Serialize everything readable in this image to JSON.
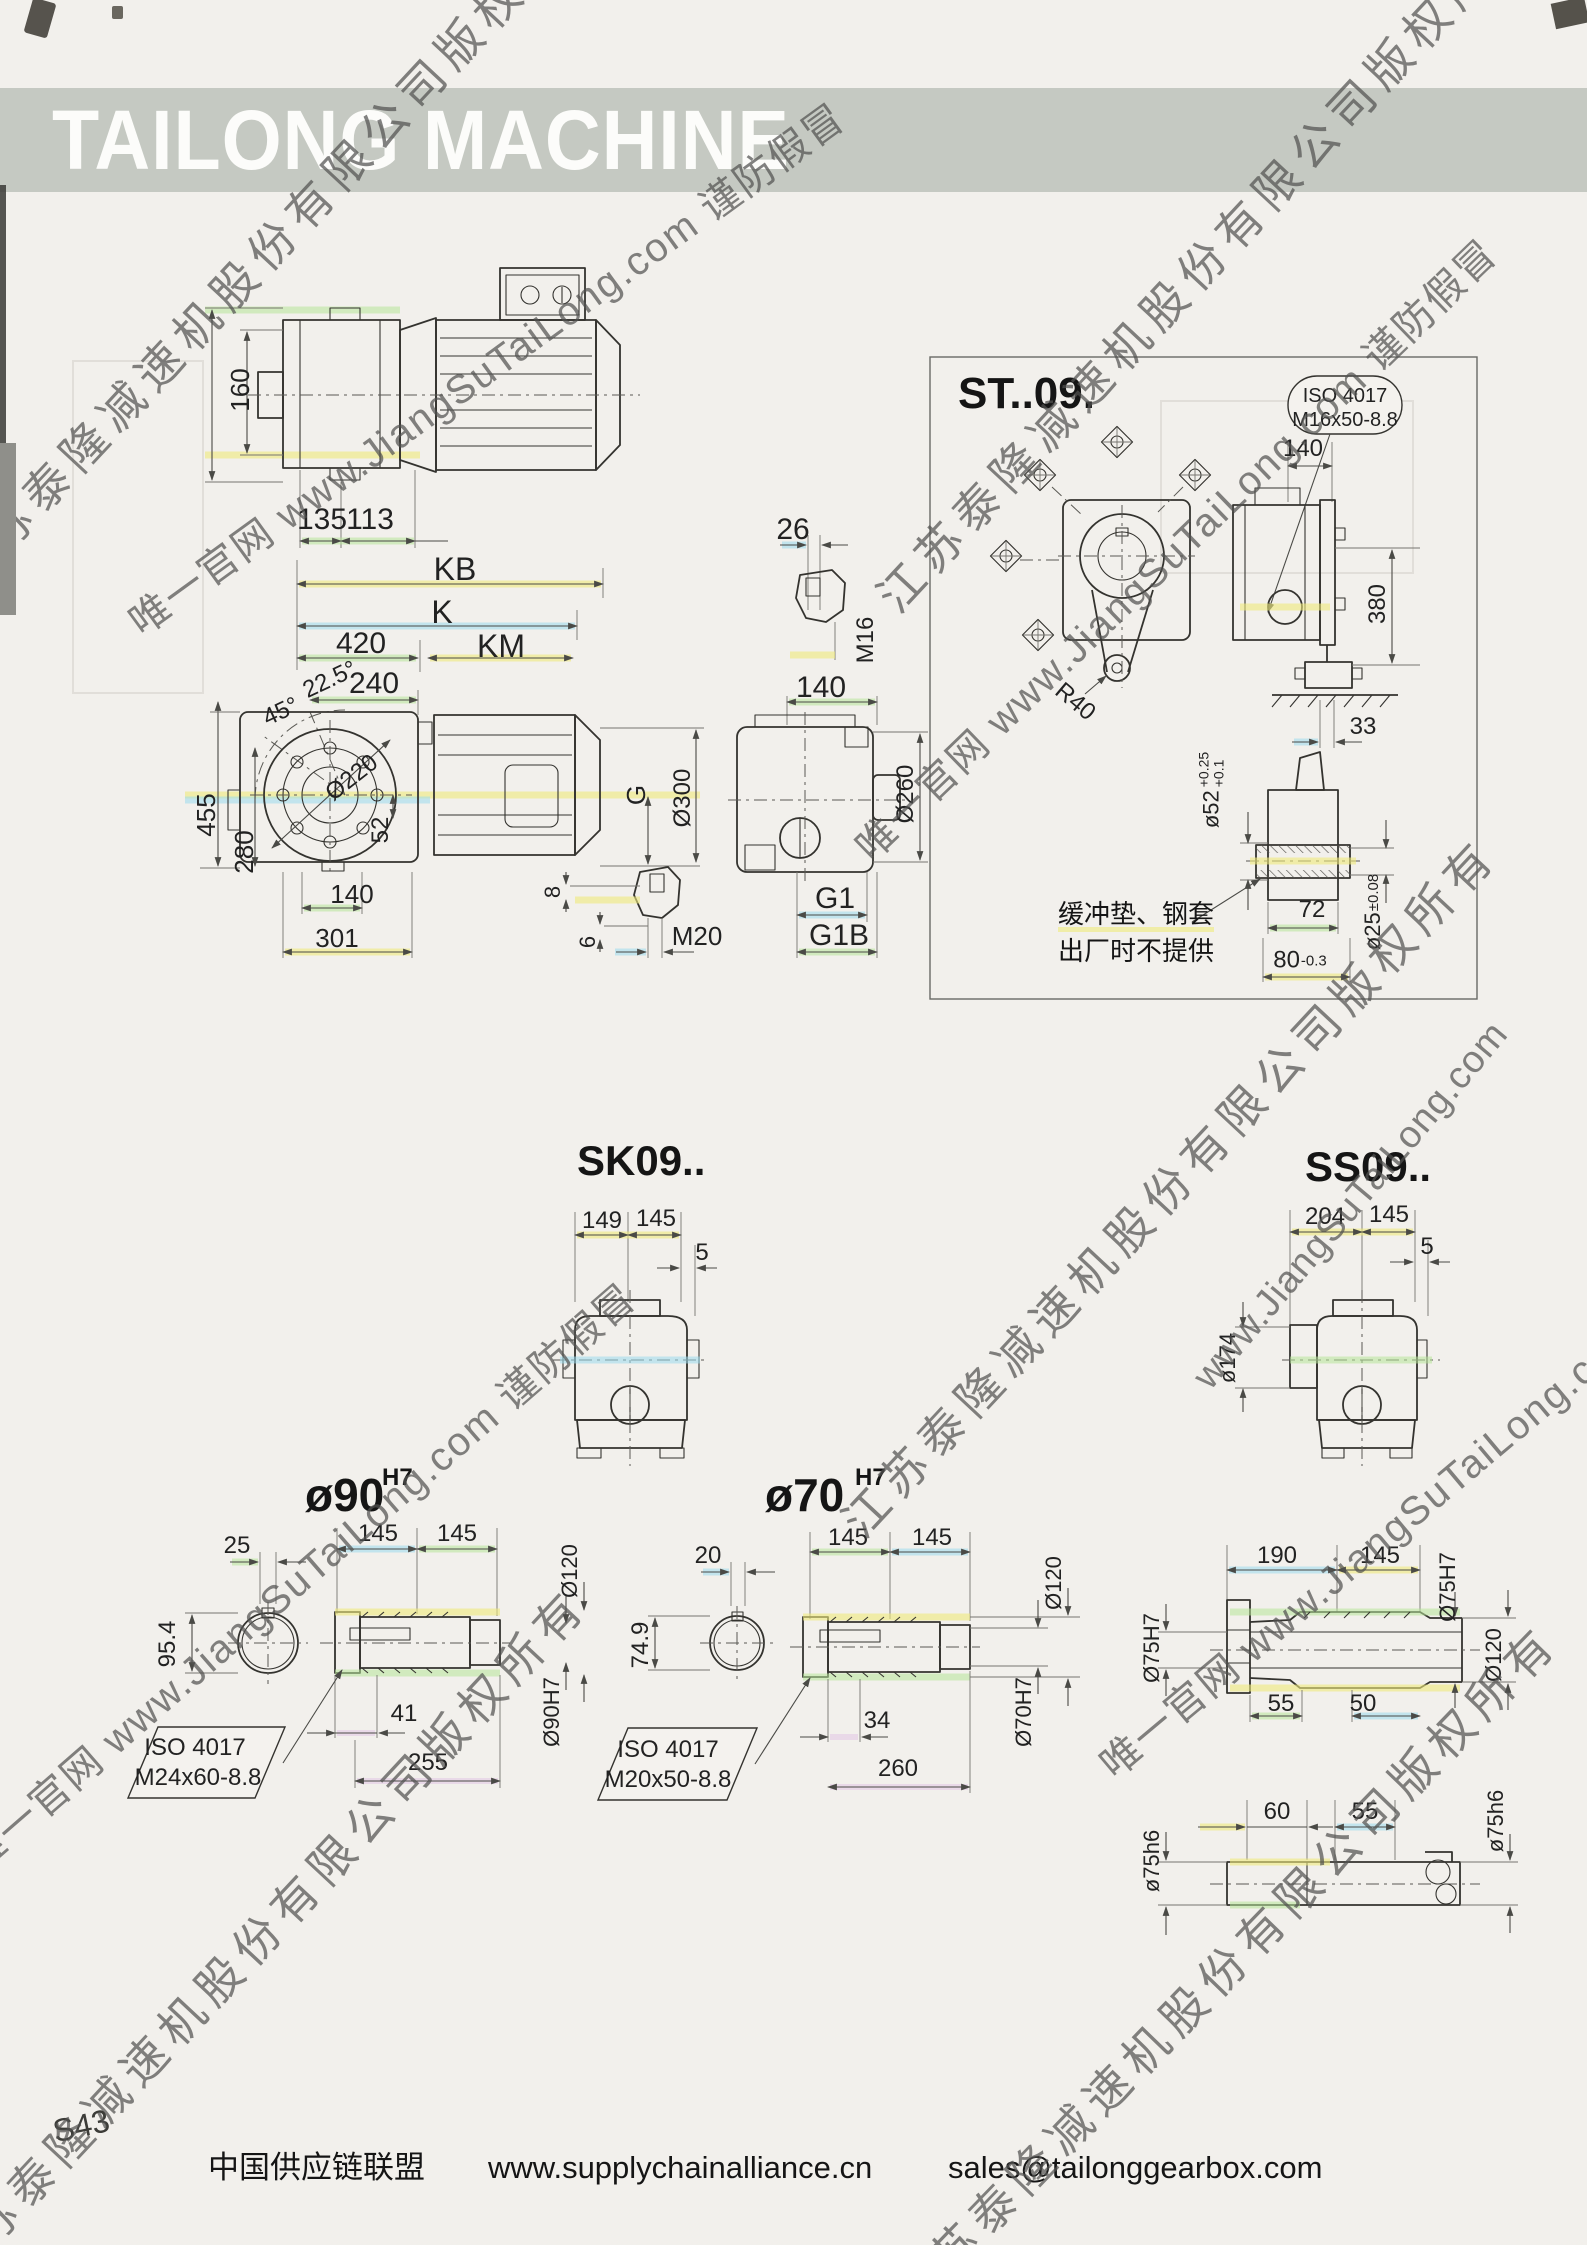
{
  "banner": {
    "title": "TAILONG MACHINE"
  },
  "watermark": {
    "company": "江苏泰隆减速机股份有限公司版权所有",
    "site": "唯一官网 www.JiangSuTaiLong.com 谨防假冒",
    "site_short": "www.JiangSuTaiLong.com"
  },
  "topview": {
    "h160": "160",
    "w135": "135",
    "w113": "113"
  },
  "lengths": {
    "kb": "KB",
    "k": "K",
    "w420": "420",
    "km": "KM"
  },
  "front": {
    "a225": "22.5°",
    "w240": "240",
    "a45": "45°",
    "dia220": "Ø220",
    "h455": "455",
    "h280": "280",
    "h52": "52",
    "w140": "140",
    "w301": "301",
    "key8": "8",
    "key6": "6",
    "m20": "M20",
    "g": "G",
    "dia300": "Ø300"
  },
  "output": {
    "w26": "26",
    "m16": "M16",
    "w140": "140",
    "dia260": "Ø260",
    "g1": "G1",
    "g1b": "G1B"
  },
  "st09": {
    "title": "ST..09.",
    "iso1": "ISO 4017",
    "iso2": "M16x50-8.8",
    "w140": "140",
    "h380": "380",
    "w33": "33",
    "r40": "R40",
    "dia52": "ø52",
    "tol52_hi": "+0.25",
    "tol52_lo": "+0.1",
    "w72": "72",
    "w80": "80",
    "tol80": "-0.3",
    "dia25": "ø25",
    "tol25": "±0.08",
    "note1": "缓冲垫、钢套",
    "note2": "出厂时不提供"
  },
  "sk09": {
    "title": "SK09..",
    "wl": "149",
    "wr": "145",
    "off": "5"
  },
  "ss09": {
    "title": "SS09..",
    "wl": "204",
    "wr": "145",
    "off": "5",
    "dia174": "ø174"
  },
  "bore90": {
    "title": "ø90",
    "tol": "H7",
    "w25": "25",
    "h95": "95.4",
    "wl": "145",
    "wr": "145",
    "w41": "41",
    "w255": "255",
    "iso1": "ISO 4017",
    "iso2": "M24x60-8.8",
    "dia120": "Ø120",
    "dia90": "Ø90H7"
  },
  "bore70": {
    "title": "ø70",
    "tol": "H7",
    "w20": "20",
    "h74": "74.9",
    "wl": "145",
    "wr": "145",
    "w34": "34",
    "w260": "260",
    "iso1": "ISO 4017",
    "iso2": "M20x50-8.8",
    "dia120": "Ø120",
    "dia70": "Ø70H7"
  },
  "sleeve75": {
    "w190": "190",
    "w145": "145",
    "dia75r": "Ø75H7",
    "dia120": "Ø120",
    "w55": "55",
    "w50": "50",
    "dia75l": "Ø75H7"
  },
  "shaft75": {
    "w60": "60",
    "w55": "55",
    "dia_l": "ø75h6",
    "dia_r": "ø75h6"
  },
  "footer": {
    "page_no": "S43",
    "org": "中国供应链联盟",
    "url": "www.supplychainalliance.cn",
    "email": "sales@tailonggearbox.com"
  }
}
